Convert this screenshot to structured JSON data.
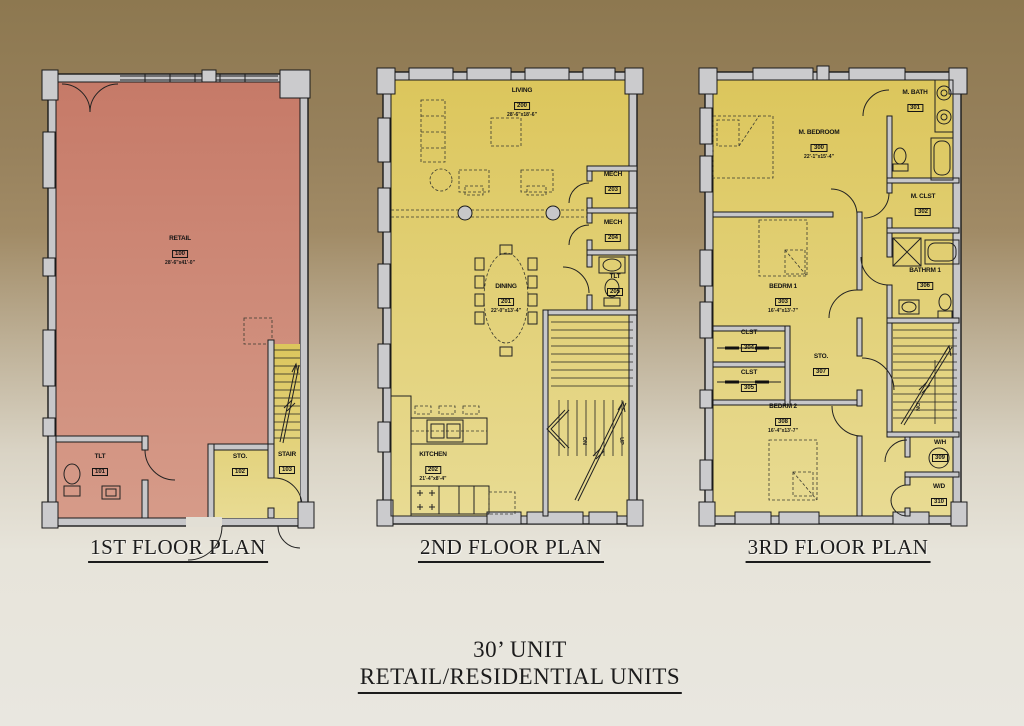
{
  "main_title": {
    "line1": "30’ UNIT",
    "line2": "RETAIL/RESIDENTIAL UNITS"
  },
  "stair_labels": {
    "up": "UP",
    "dn": "DN"
  },
  "colors": {
    "background_top": "#97815c",
    "background_bottom": "#e9e7e0",
    "retail_fill": "#ca8070",
    "residential_fill": "#ddc75e",
    "wall_fill": "#c7c7c9",
    "line": "#1a1a1a"
  },
  "plans": [
    {
      "title": "1ST FLOOR PLAN",
      "rooms": [
        {
          "name": "RETAIL",
          "number": "100",
          "dims": "28'-6\"x41'-0\""
        },
        {
          "name": "TLT",
          "number": "101"
        },
        {
          "name": "STO.",
          "number": "102"
        },
        {
          "name": "STAIR",
          "number": "103"
        }
      ]
    },
    {
      "title": "2ND FLOOR PLAN",
      "rooms": [
        {
          "name": "LIVING",
          "number": "200",
          "dims": "28'-6\"x18'-6\""
        },
        {
          "name": "DINING",
          "number": "201",
          "dims": "22'-0\"x13'-4\""
        },
        {
          "name": "KITCHEN",
          "number": "202",
          "dims": "21'-4\"x8'-4\""
        },
        {
          "name": "MECH",
          "number": "203"
        },
        {
          "name": "MECH",
          "number": "204"
        },
        {
          "name": "TLT",
          "number": "205"
        }
      ]
    },
    {
      "title": "3RD FLOOR PLAN",
      "rooms": [
        {
          "name": "M. BEDROOM",
          "number": "300",
          "dims": "22'-1\"x15'-4\""
        },
        {
          "name": "M. BATH",
          "number": "301"
        },
        {
          "name": "M. CLST",
          "number": "302"
        },
        {
          "name": "BEDRM 1",
          "number": "303",
          "dims": "16'-4\"x13'-7\""
        },
        {
          "name": "CLST",
          "number": "304"
        },
        {
          "name": "CLST",
          "number": "305"
        },
        {
          "name": "BATHRM 1",
          "number": "306"
        },
        {
          "name": "STO.",
          "number": "307"
        },
        {
          "name": "BEDRM 2",
          "number": "308",
          "dims": "16'-4\"x13'-7\""
        },
        {
          "name": "W/H",
          "number": "309"
        },
        {
          "name": "W/D",
          "number": "310"
        }
      ]
    }
  ]
}
